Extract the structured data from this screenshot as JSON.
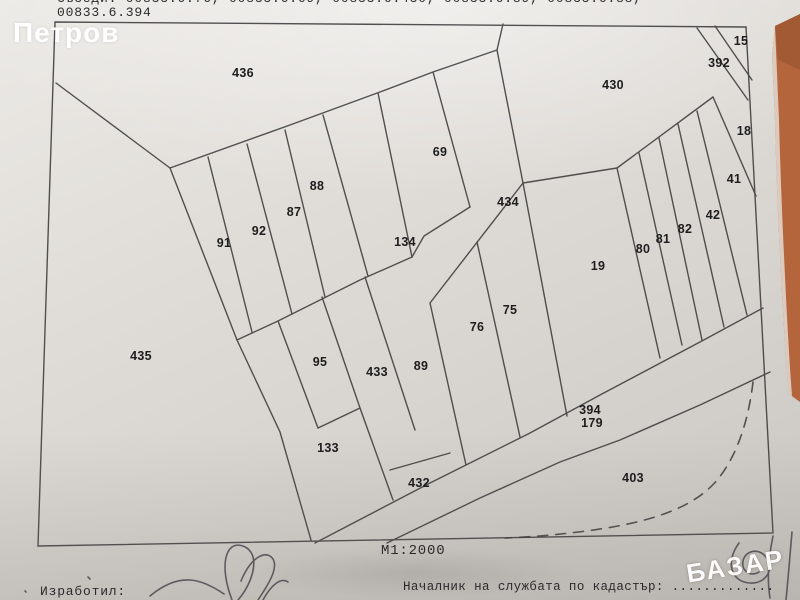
{
  "header": {
    "neighbors_line1": "Съседи: 00833.6.76, 00833.6.69, 00833.6.430, 00833.6.89, 00833.6.88,",
    "neighbors_line2": "00833.6.394"
  },
  "watermarks": {
    "top_left_name": "Петров",
    "bottom_right_site": "БАЗАР"
  },
  "map": {
    "scale": "М1:2000",
    "parcels": [
      {
        "id": "436",
        "x": 243,
        "y": 73
      },
      {
        "id": "430",
        "x": 613,
        "y": 85
      },
      {
        "id": "392",
        "x": 719,
        "y": 63
      },
      {
        "id": "15",
        "x": 741,
        "y": 41
      },
      {
        "id": "18",
        "x": 744,
        "y": 131
      },
      {
        "id": "41",
        "x": 734,
        "y": 179
      },
      {
        "id": "42",
        "x": 713,
        "y": 215
      },
      {
        "id": "82",
        "x": 685,
        "y": 229
      },
      {
        "id": "81",
        "x": 663,
        "y": 239
      },
      {
        "id": "80",
        "x": 643,
        "y": 249
      },
      {
        "id": "19",
        "x": 598,
        "y": 266
      },
      {
        "id": "434",
        "x": 508,
        "y": 202
      },
      {
        "id": "69",
        "x": 440,
        "y": 152
      },
      {
        "id": "88",
        "x": 317,
        "y": 186
      },
      {
        "id": "87",
        "x": 294,
        "y": 212
      },
      {
        "id": "92",
        "x": 259,
        "y": 231
      },
      {
        "id": "91",
        "x": 224,
        "y": 243
      },
      {
        "id": "134",
        "x": 405,
        "y": 242
      },
      {
        "id": "435",
        "x": 141,
        "y": 356
      },
      {
        "id": "95",
        "x": 320,
        "y": 362
      },
      {
        "id": "433",
        "x": 377,
        "y": 372
      },
      {
        "id": "89",
        "x": 421,
        "y": 366
      },
      {
        "id": "76",
        "x": 477,
        "y": 327
      },
      {
        "id": "75",
        "x": 510,
        "y": 310
      },
      {
        "id": "133",
        "x": 328,
        "y": 448
      },
      {
        "id": "432",
        "x": 419,
        "y": 483
      },
      {
        "id": "394",
        "x": 590,
        "y": 410
      },
      {
        "id": "179",
        "x": 592,
        "y": 423
      },
      {
        "id": "403",
        "x": 633,
        "y": 478
      }
    ]
  },
  "footer": {
    "prepared_by": "Изработил:",
    "chief": "Началник на службата по кадастър: ............."
  },
  "colors": {
    "paper": "#dcd9d4",
    "boundary_line": "#3b3b3b",
    "desk_background": "#b5653c",
    "pen_ink": "#4a4a52",
    "label_ink": "#1d1d1d"
  }
}
